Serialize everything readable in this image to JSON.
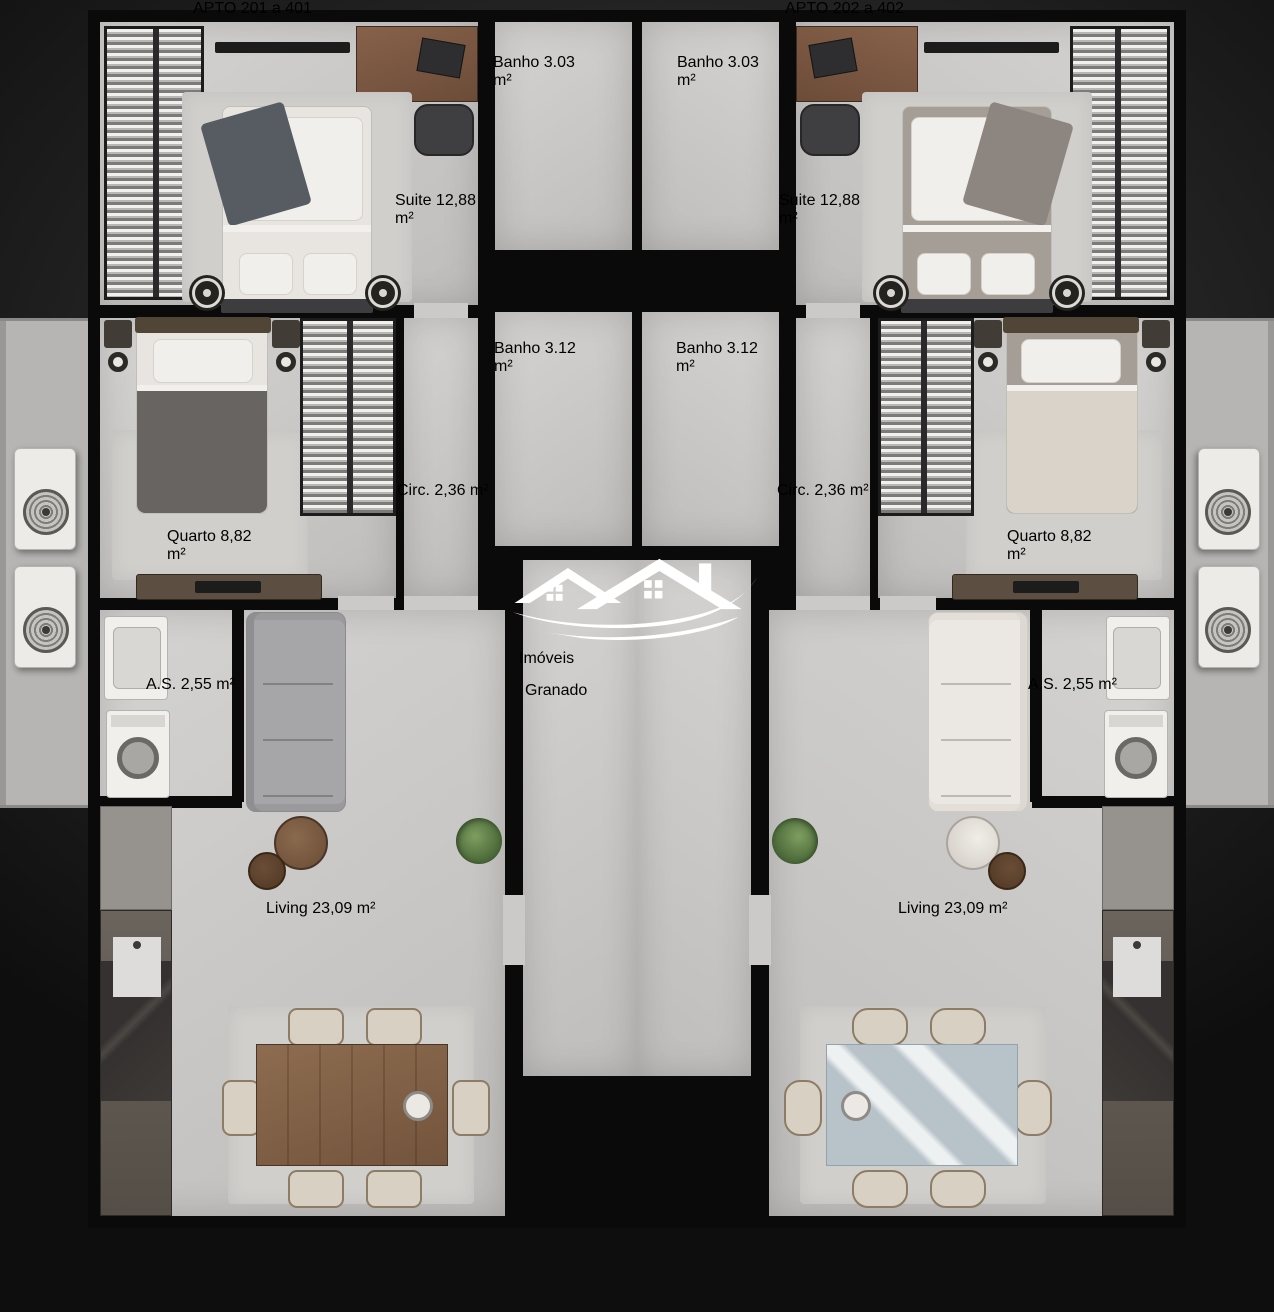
{
  "watermark": {
    "line1": "Imóveis",
    "line2": "Granado"
  },
  "banners": {
    "left": "APTO 201 a 401",
    "right": "APTO 202 a 402"
  },
  "rooms": {
    "suite": {
      "name": "Suite",
      "area": "12,88 m²"
    },
    "banho_suite": {
      "name": "Banho",
      "area": "3.03 m²"
    },
    "banho_social": {
      "name": "Banho",
      "area": "3.12 m²"
    },
    "circ": {
      "name": "Circ.",
      "area": "2,36 m²"
    },
    "quarto": {
      "name": "Quarto",
      "area": "8,82 m²"
    },
    "as": {
      "name": "A.S.",
      "area": "2,55 m²"
    },
    "living": {
      "name": "Living",
      "area": "23,09 m²"
    }
  },
  "colors": {
    "banner_bg": "#46416b",
    "wall": "#0a0a0a",
    "floor": "#c9c8c6",
    "shaft_box": "#8e98a6",
    "glass_divider": "#7e95a8",
    "watermark_text": "#ffffff"
  }
}
